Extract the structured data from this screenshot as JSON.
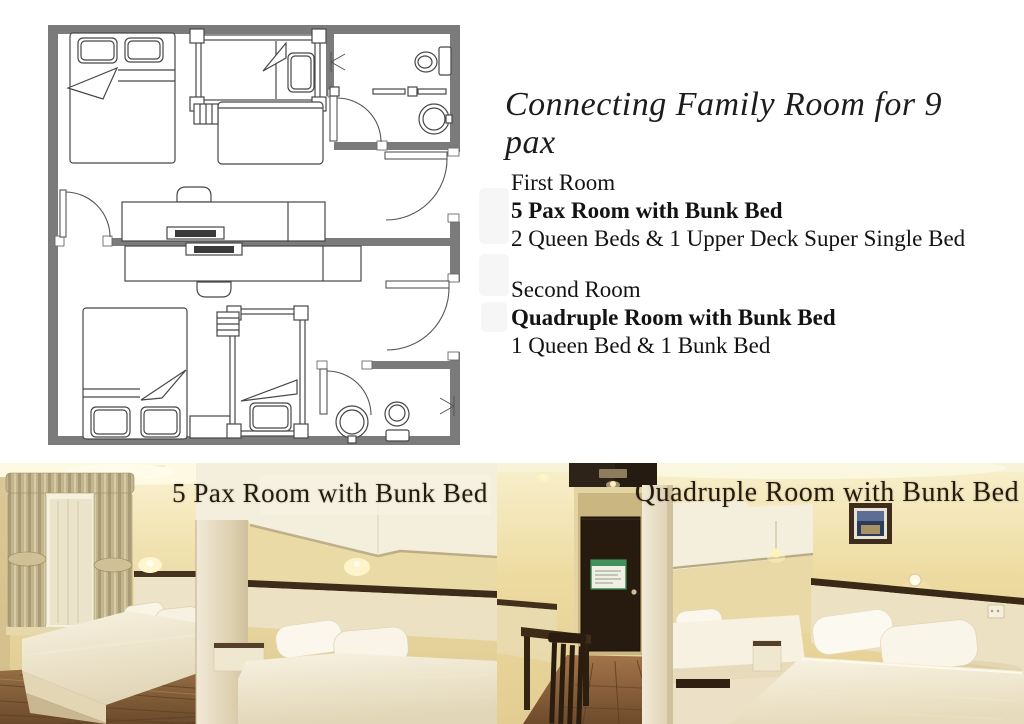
{
  "header": {
    "title": "Connecting Family Room for 9 pax"
  },
  "rooms": [
    {
      "label": "First Room",
      "name": "5 Pax Room with Bunk Bed",
      "beds": "2 Queen Beds & 1 Upper Deck Super Single Bed"
    },
    {
      "label": "Second Room",
      "name": "Quadruple Room with Bunk Bed",
      "beds": "1 Queen Bed & 1 Bunk Bed"
    }
  ],
  "photos": [
    {
      "caption": "5 Pax Room with Bunk Bed"
    },
    {
      "caption": "Quadruple Room with Bunk Bed"
    }
  ],
  "floor_plan": {
    "wall_color": "#7b7b7b",
    "line_color": "#474747",
    "features": [
      "queen-bed",
      "bunk-bed",
      "desk",
      "tv",
      "chair",
      "toilet",
      "sink",
      "entry-door",
      "connecting-door",
      "bathroom"
    ]
  }
}
